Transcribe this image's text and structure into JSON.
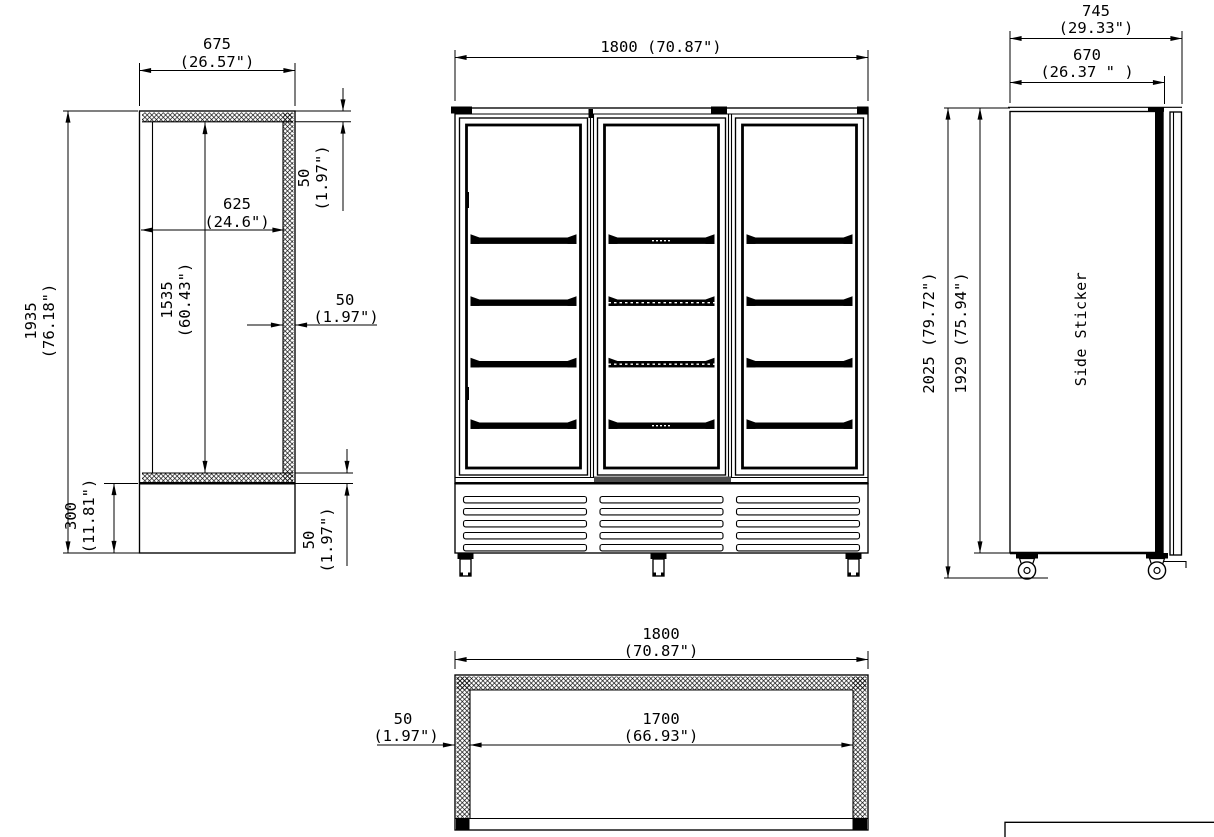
{
  "drawing": {
    "section_view": {
      "width_mm": "675",
      "width_in": "(26.57\")",
      "overall_height_mm": "1935",
      "overall_height_in": "(76.18\")",
      "inner_width_mm": "625",
      "inner_width_in": "(24.6\")",
      "inner_height_mm": "1535",
      "inner_height_in": "(60.43\")",
      "top_wall_mm": "50",
      "top_wall_in": "(1.97\")",
      "back_wall_mm": "50",
      "back_wall_in": "(1.97\")",
      "base_height_mm": "300",
      "base_height_in": "(11.81\")",
      "bottom_wall_mm": "50",
      "bottom_wall_in": "(1.97\")"
    },
    "front_view": {
      "width_label": "1800 (70.87\")"
    },
    "side_view": {
      "depth_overall_mm": "745",
      "depth_overall_in": "(29.33\")",
      "depth_body_mm": "670",
      "depth_body_in": "(26.37 \" )",
      "height_overall_label": "2025 (79.72\")",
      "height_body_label": "1929 (75.94\")",
      "sticker_label": "Side Sticker"
    },
    "top_view": {
      "width_mm": "1800",
      "width_in": "(70.87\")",
      "inner_width_mm": "1700",
      "inner_width_in": "(66.93\")",
      "wall_mm": "50",
      "wall_in": "(1.97\")"
    }
  }
}
